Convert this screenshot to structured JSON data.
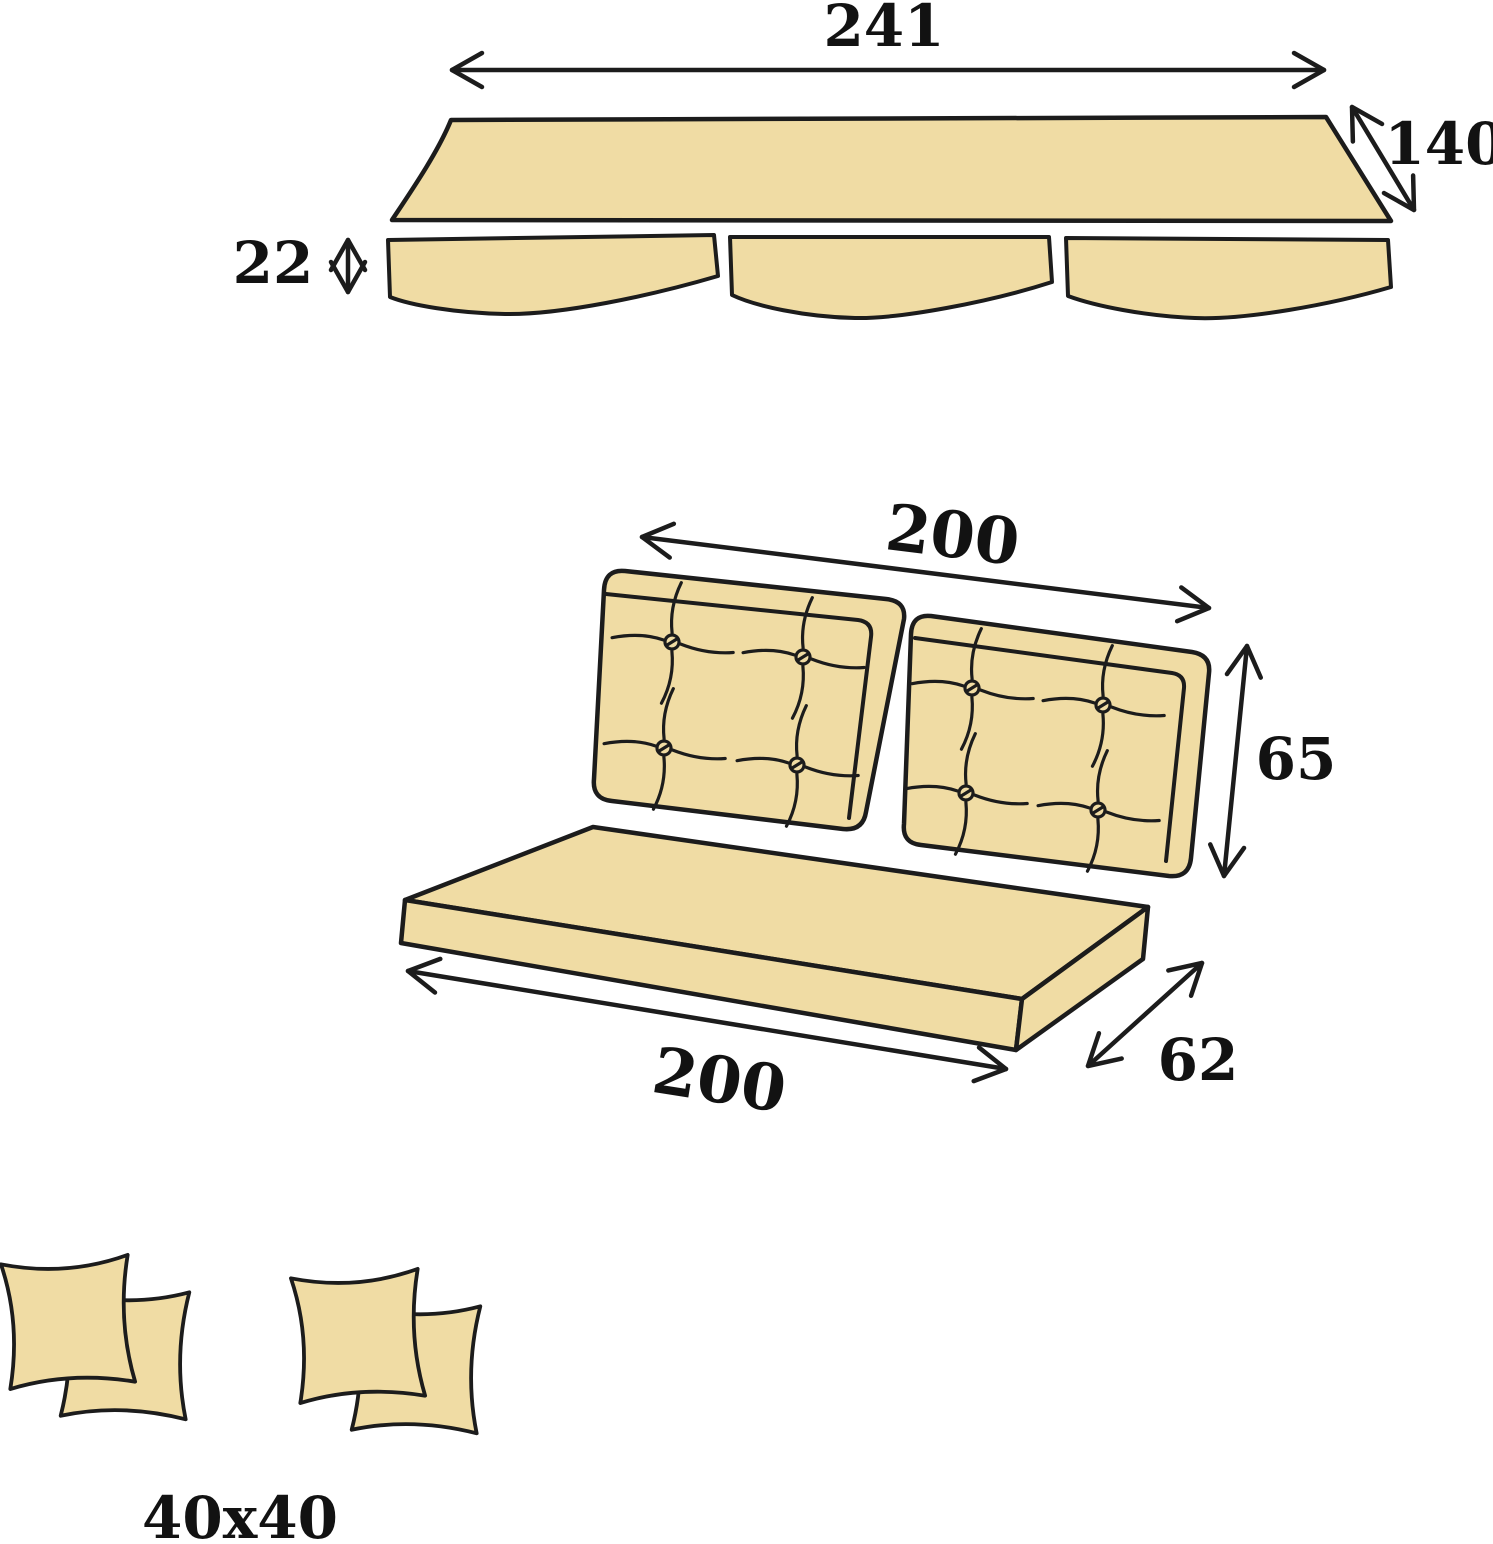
{
  "diagram": {
    "type": "swing-cushion-set-dimension-diagram",
    "canopy": {
      "width": "241",
      "side_depth": "140",
      "valance_height": "22"
    },
    "backrest": {
      "width": "200",
      "height": "65"
    },
    "seat": {
      "width": "200",
      "depth": "62"
    },
    "pillows": {
      "size": "40x40"
    }
  },
  "colors": {
    "fabric": "#f0dca4",
    "outline": "#1c1c1c",
    "label": "#121212",
    "background": "#ffffff"
  }
}
